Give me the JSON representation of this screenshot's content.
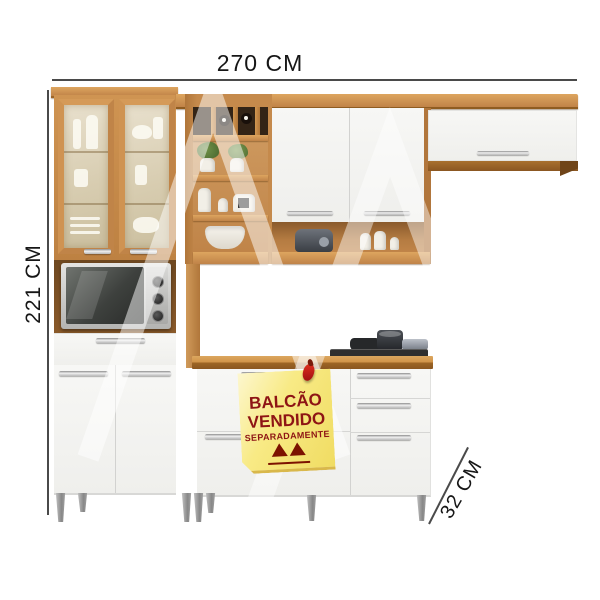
{
  "image": {
    "dimensions": {
      "width": "270 CM",
      "height": "221 CM",
      "depth": "32 CM"
    },
    "note": {
      "line1": "BALCÃO",
      "line2": "VENDIDO",
      "line3": "SEPARADAMENTE"
    },
    "colors": {
      "wood": "#c4874a",
      "countertop": "#d19449",
      "door_white": "#f4f4f2",
      "note_yellow": "#f6e878",
      "note_text_red": "#8e1414",
      "dimension_line": "#4a4a4a",
      "leg_silver": "#a8a8a8",
      "cooktop_black": "#2f2f2f"
    },
    "icons": {
      "pin": "red-pin-icon",
      "logo": "double-triangle-brand-logo",
      "watermark": "double-a-watermark"
    }
  }
}
